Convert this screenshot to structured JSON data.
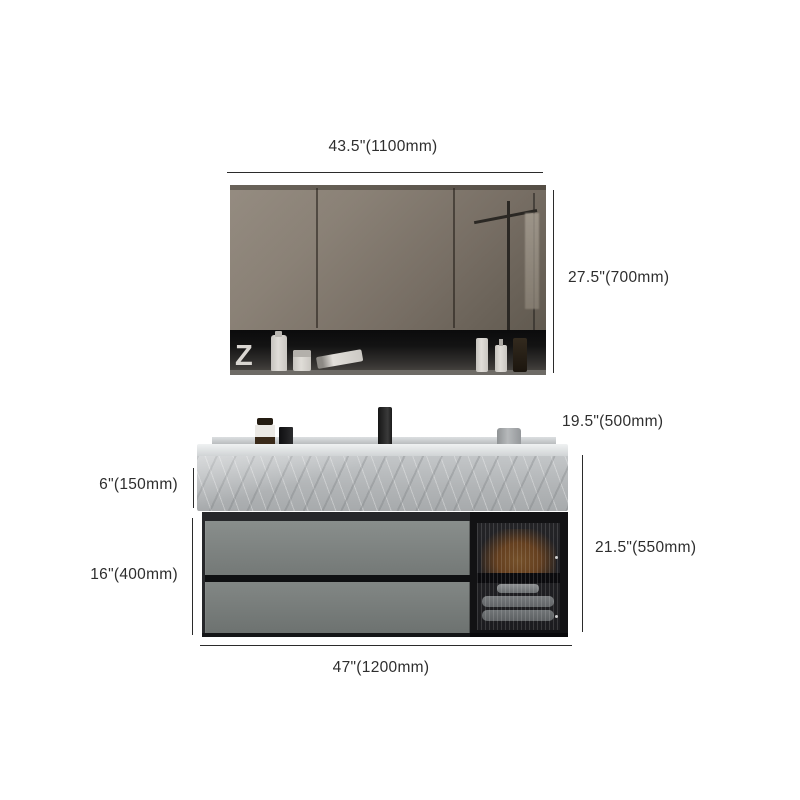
{
  "colors": {
    "text": "#2e2e2e",
    "line": "#2b2b2b",
    "mirror-top": "#958c81",
    "mirror-bottom": "#60594f",
    "shelf-dark": "#131313",
    "frame-dark": "#232325",
    "marble-light": "#c3c6c8",
    "marble-mid": "#b2b5b7",
    "marble-dark": "#a7aaac",
    "drawer-gray": "#7d827f",
    "amber": "#8a5526",
    "towel-gray": "#9aa0a2",
    "faucet-black": "#161616"
  },
  "dimensions": {
    "mirror_width": {
      "label": "43.5\"(1100mm)"
    },
    "mirror_height": {
      "label": "27.5\"(700mm)"
    },
    "counter_depth": {
      "label": "19.5\"(500mm)"
    },
    "apron_height": {
      "label": "6\"(150mm)"
    },
    "drawer_section_height": {
      "label": "16\"(400mm)"
    },
    "vanity_height": {
      "label": "21.5\"(550mm)"
    },
    "vanity_width": {
      "label": "47\"(1200mm)"
    }
  },
  "mirror_shelf": {
    "decor_letter": "Z"
  }
}
